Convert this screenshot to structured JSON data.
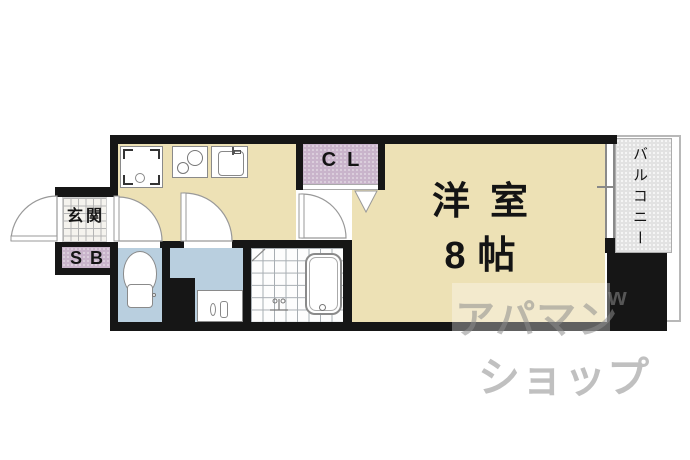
{
  "plan_title": "1K apartment floor plan",
  "rooms": {
    "genkan": "玄関",
    "shoe_box": "SB",
    "closet": "CL",
    "main_room_name": "洋室",
    "main_room_size": "8帖",
    "balcony": "バルコニー"
  },
  "fixtures": {
    "washer": "washing-machine-space",
    "stove": "two-burner-stove",
    "sink": "kitchen-sink",
    "toilet": "toilet",
    "basin": "washbasin",
    "bathtub": "bathtub"
  },
  "colors": {
    "wall": "#161616",
    "floor": "#EDE1B5",
    "closet": "#C9B4CB",
    "wet": "#B9CFDF",
    "balcony": "#E2E2E2",
    "line": "#8a8a8a",
    "label": "#141414",
    "watermark": "rgba(140,140,140,0.55)"
  },
  "watermark": {
    "line1": "アパマン",
    "line2": "ショップ",
    "mark": "w"
  }
}
